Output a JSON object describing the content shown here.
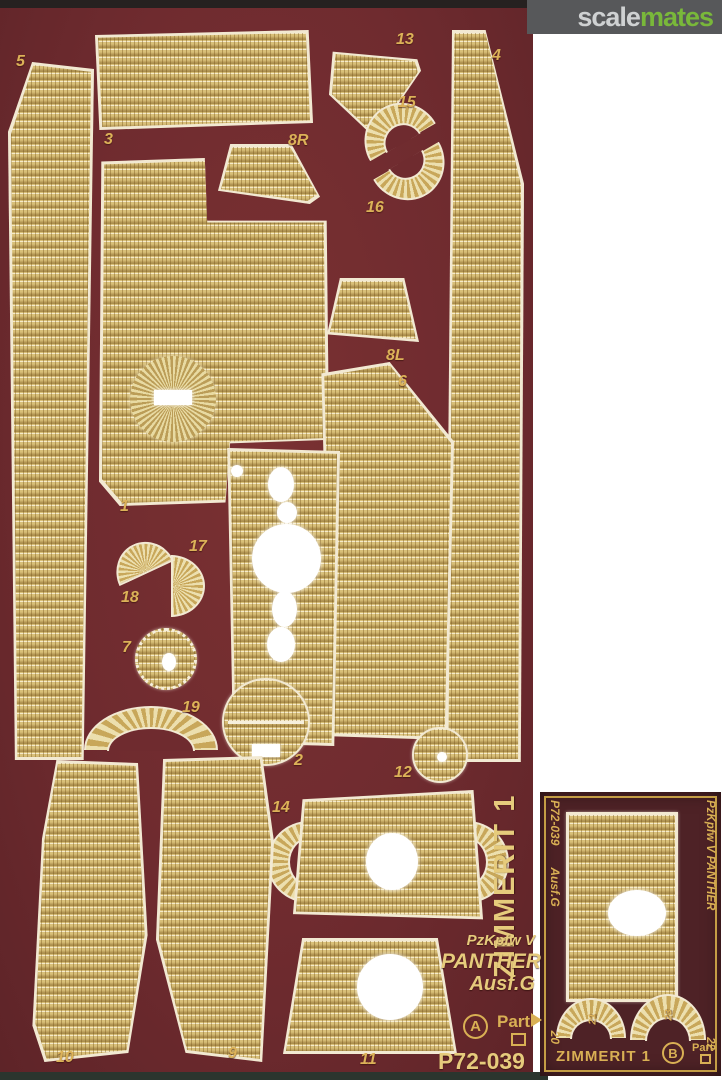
{
  "site": {
    "brand_scale": "scale",
    "brand_mates": "mates"
  },
  "main_fret": {
    "side_title": "ZIMMERIT 1",
    "vehicle_line1": "PzKpfw V",
    "vehicle_line2": "PANTHER",
    "vehicle_line3": "Ausf.G",
    "scale_letter": "A",
    "brand": "Part",
    "product_code": "P72-039",
    "part_labels": {
      "n5": "5",
      "n3": "3",
      "n13": "13",
      "n4": "4",
      "n15": "15",
      "n16": "16",
      "n8R": "8R",
      "n8L": "8L",
      "n6": "6",
      "n1": "1",
      "n17": "17",
      "n18": "18",
      "n7": "7",
      "n19": "19",
      "n2": "2",
      "n12": "12",
      "n14": "14",
      "n10": "10",
      "n9": "9",
      "n11": "11"
    }
  },
  "small_fret": {
    "edge_code": "P72-039",
    "edge_variant": "Ausf.G",
    "edge_num_left": "20",
    "edge_vehicle": "PzKpfw V PANTHER",
    "edge_num_right": "22",
    "arc_num_left": "21",
    "arc_num_right": "23",
    "bottom_title": "ZIMMERIT 1",
    "scale_letter": "B",
    "brand": "Part"
  },
  "colors": {
    "card_maroon": "#6f2b2f",
    "small_card_maroon": "#4e2226",
    "brass": "#d8bf78",
    "gold_text": "#d9b054",
    "logo_green": "#79b83a",
    "logo_gray_bg": "#57585a"
  }
}
